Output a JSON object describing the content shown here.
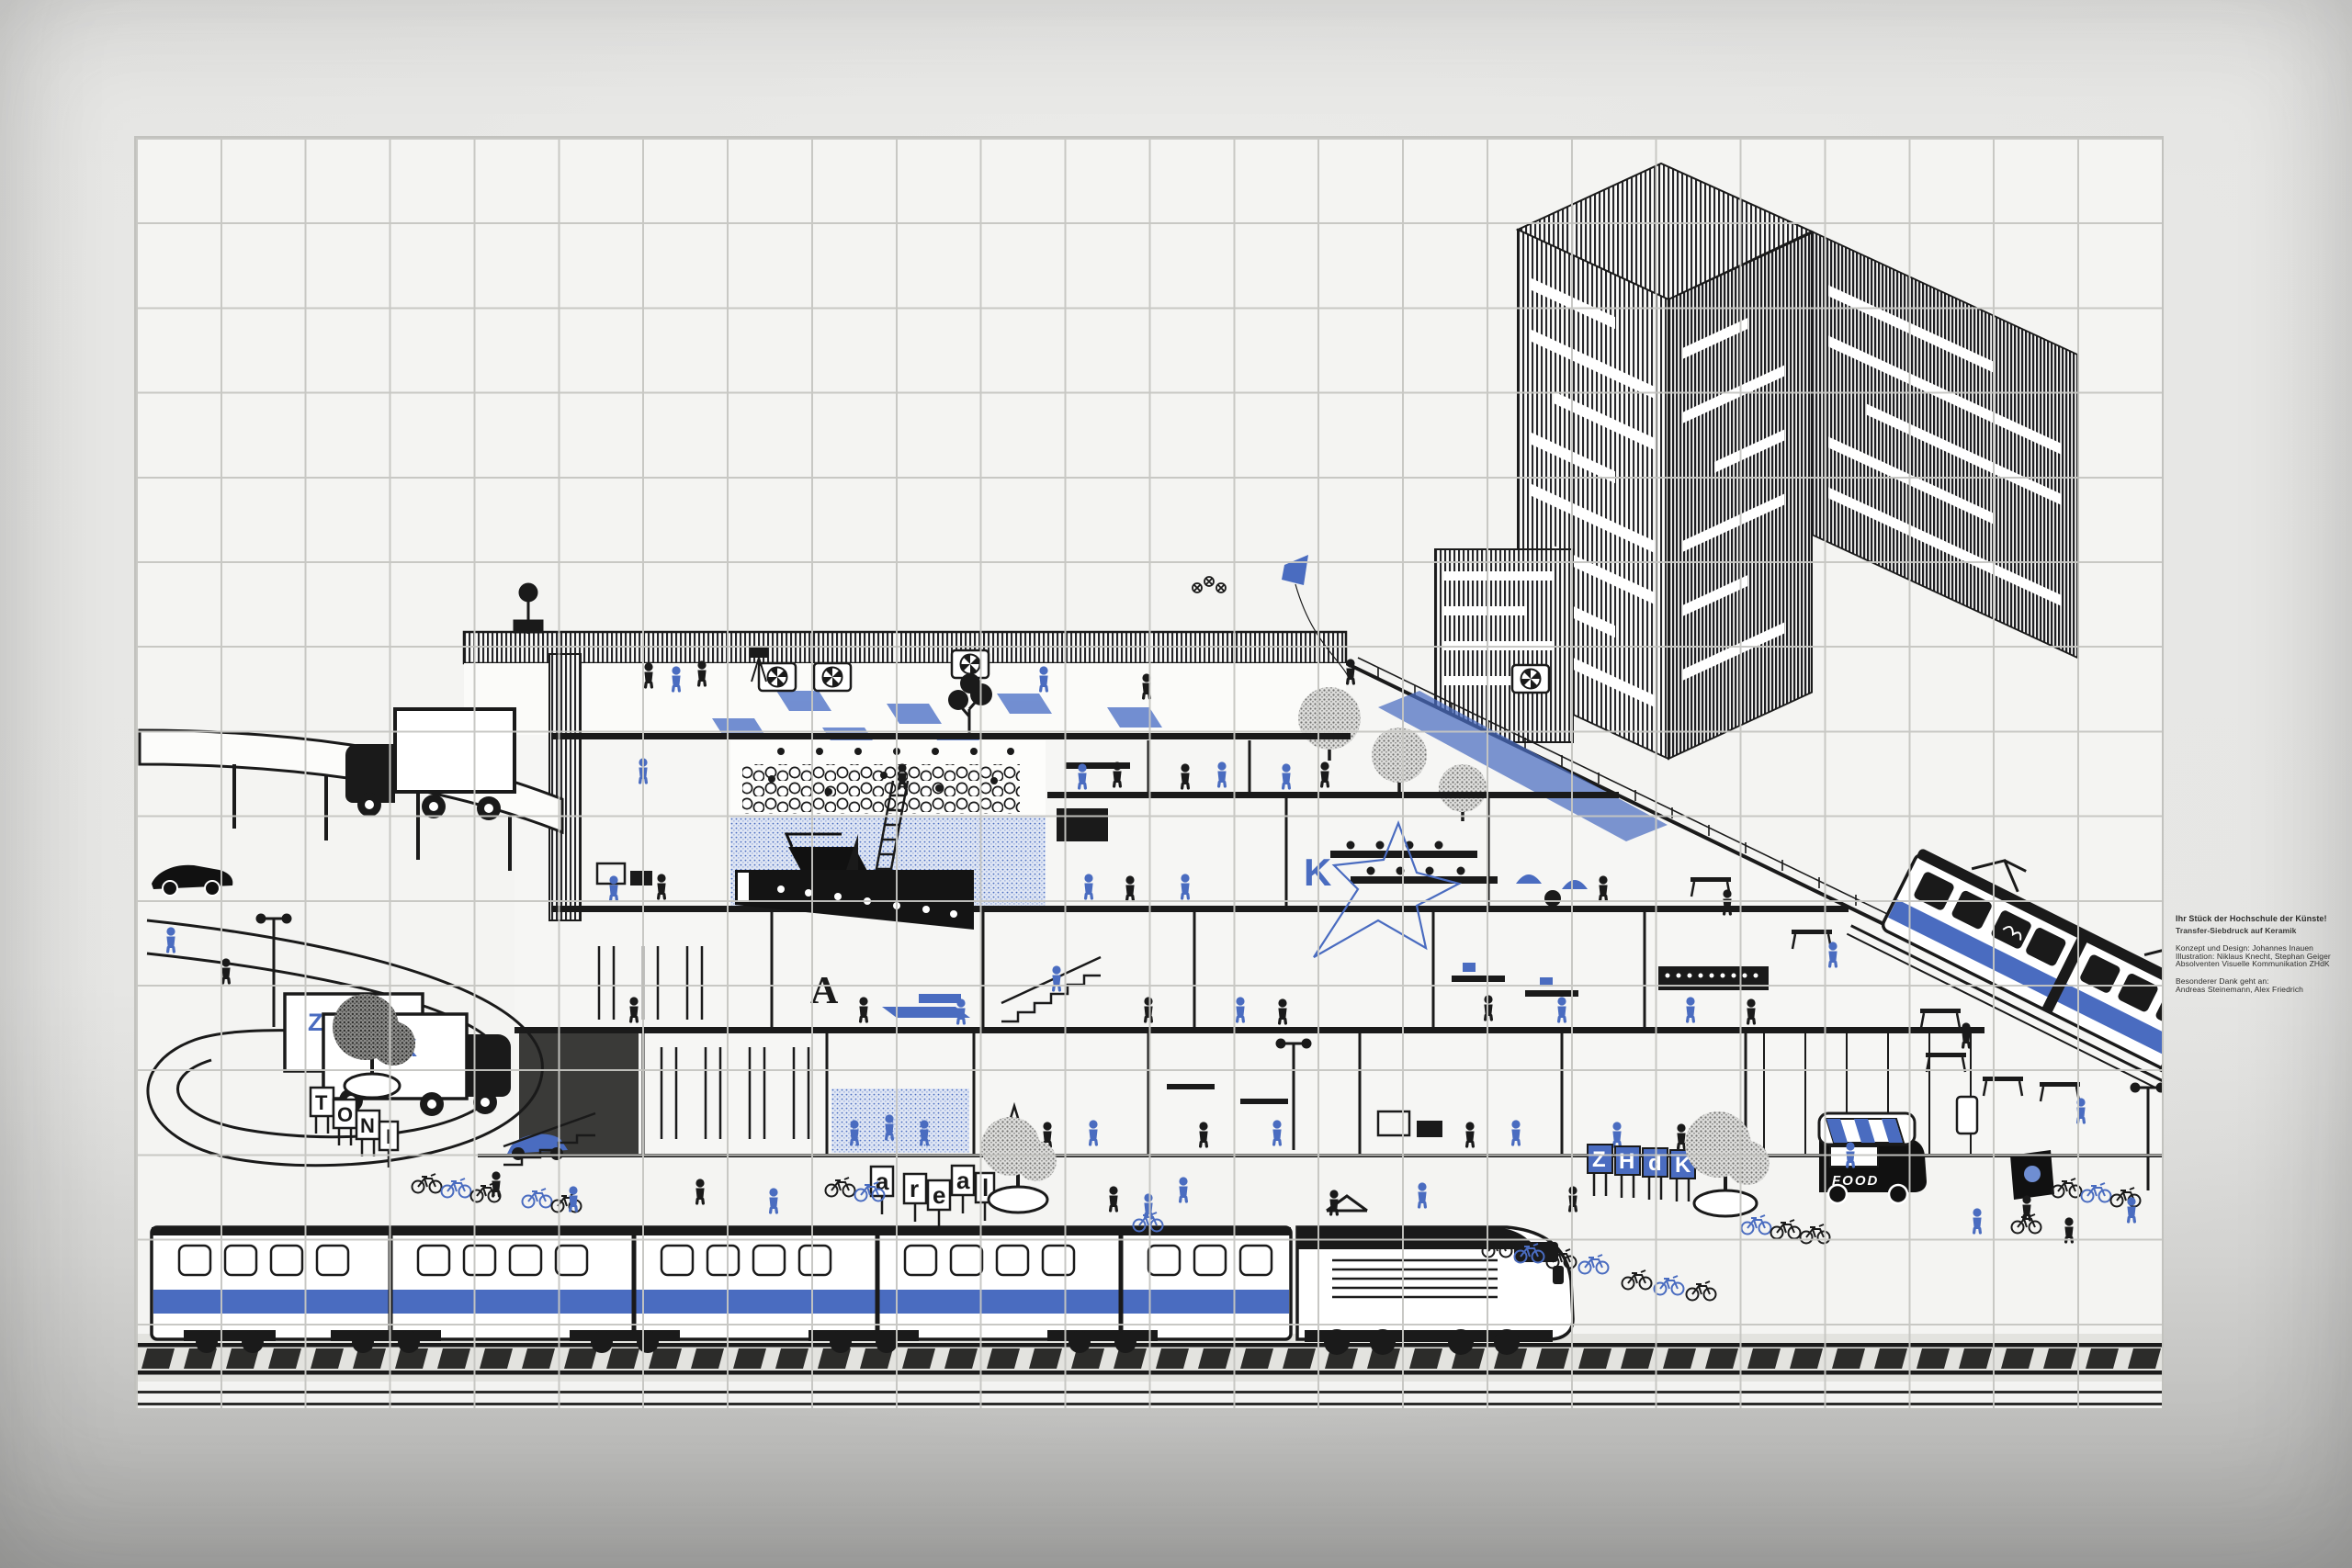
{
  "artwork": {
    "label": {
      "title": "Ihr Stück der Hochschule der Künste!",
      "subtitle": "Transfer-Siebdruck auf Keramik",
      "credit_lines": [
        "Konzept und Design: Johannes Inauen",
        "Illustration: Niklaus Knecht, Stephan Geiger",
        "Absolventen Visuelle Kommunikation ZHdK"
      ],
      "thanks_lines": [
        "Besonderer Dank geht an:",
        "Andreas Steinemann, Alex Friedrich"
      ]
    },
    "signs": {
      "toni_letters": [
        "T",
        "O",
        "N",
        "I"
      ],
      "areal_letters": [
        "a",
        "r",
        "e",
        "a",
        "l"
      ],
      "zhdk_sign_letters": [
        "Z",
        "H",
        "d",
        "K"
      ],
      "truck_labels": [
        "ZHdK",
        "ZHdK"
      ],
      "food_truck_label": "FOOD",
      "hall_letter": "A",
      "wall_letter": "K",
      "tram_route_number": "4"
    },
    "colors": {
      "ink_black": "#1a1a1a",
      "accent_blue": "#4a6cc0",
      "light_blue_floor": "#dfe6f4",
      "tile_white": "#f4f4f2",
      "grout_gray": "#c6c6c2",
      "wall_gray": "#e6e6e4"
    }
  }
}
